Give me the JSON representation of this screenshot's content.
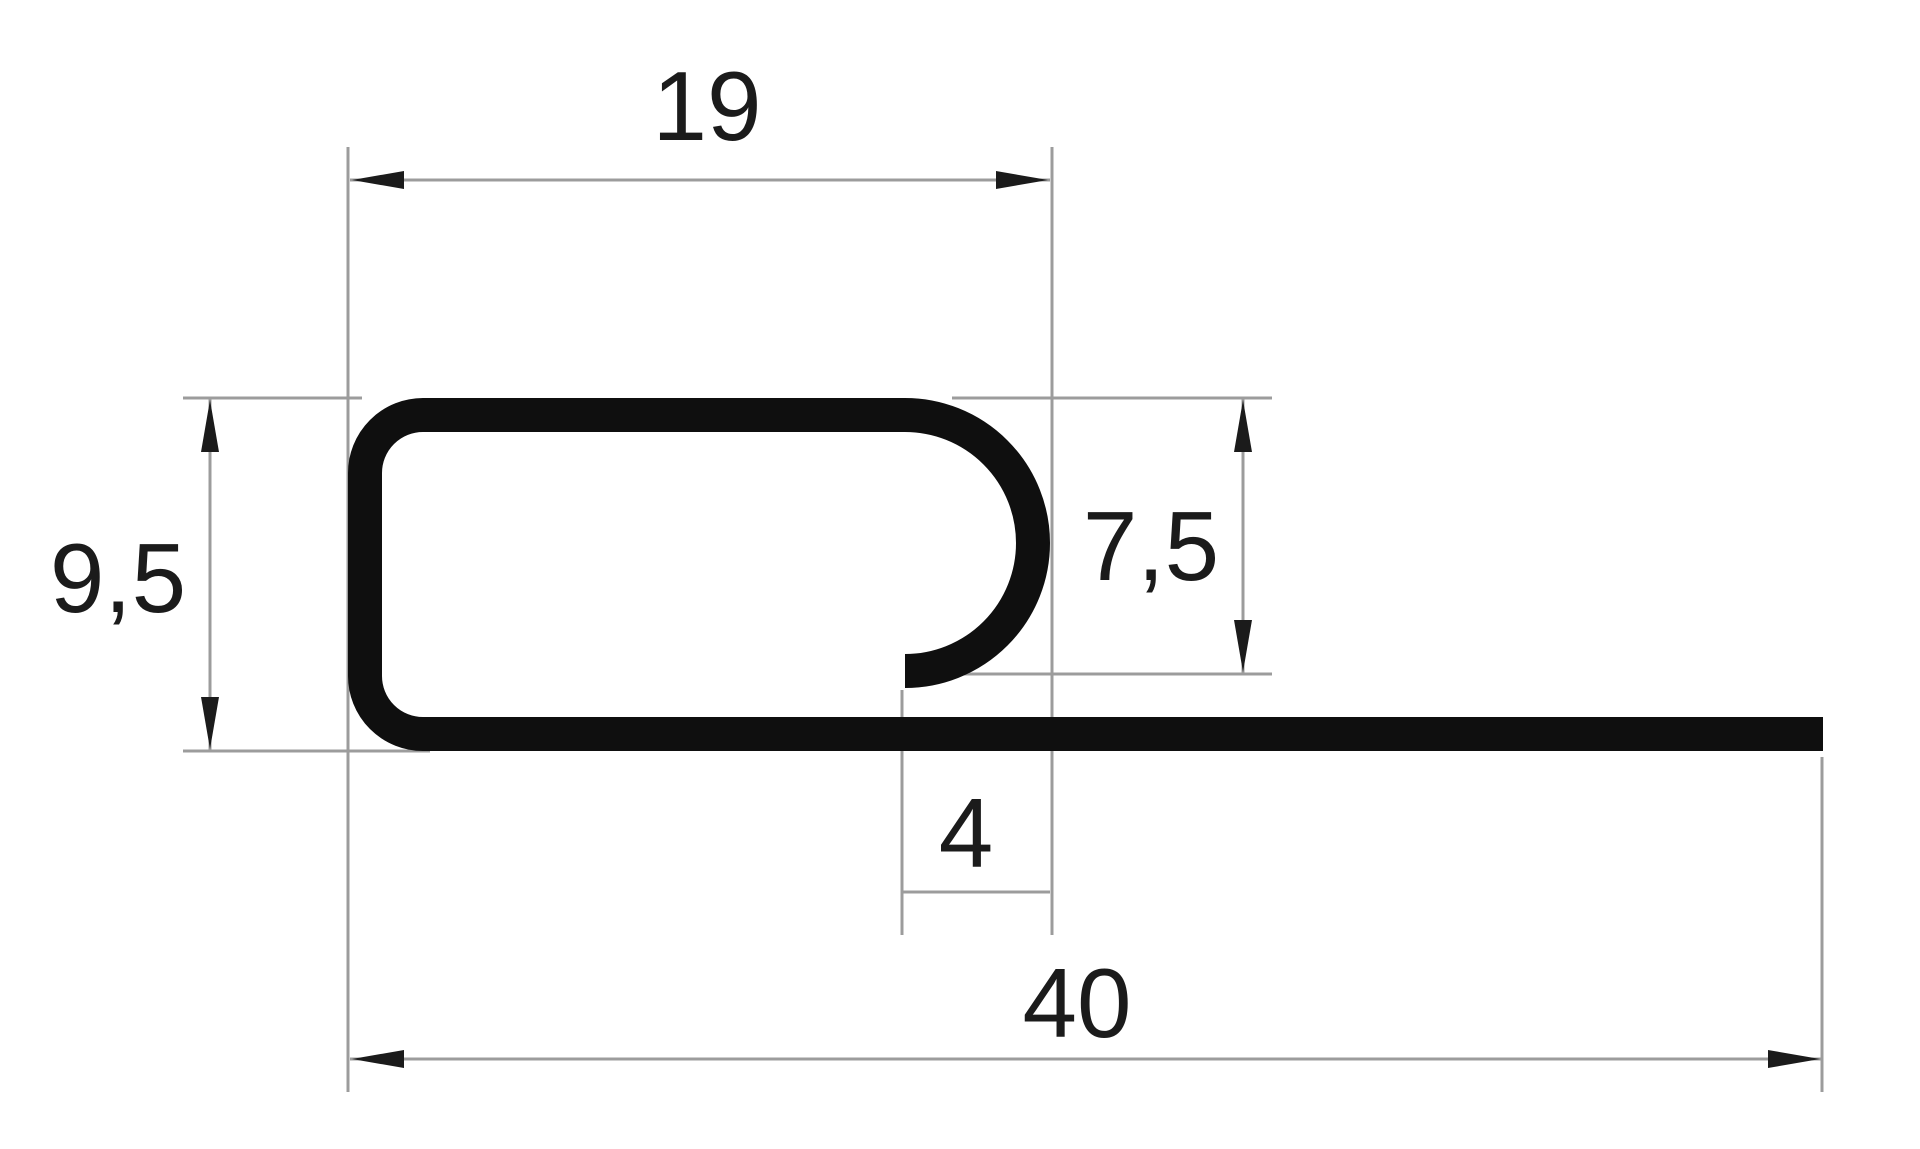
{
  "figure": {
    "title": "Dimensioned profile cross-section drawing",
    "type": "technical-drawing",
    "shape": "J-shaped channel profile with rounded corners, open hook on the right side and a long flat flange extending to the right"
  },
  "colors": {
    "bg-color": "#ffffff",
    "profile-color": "#0f0f0f",
    "dim-color": "#9c9c9c",
    "ink-color": "#1b1b1b"
  },
  "dimensions": {
    "top_width": {
      "label": "19",
      "value": 19,
      "orientation": "horizontal",
      "measures": "outer width of the channel box"
    },
    "left_height": {
      "label": "9,5",
      "value": 9.5,
      "orientation": "vertical",
      "measures": "outer height of the channel box"
    },
    "hook_height": {
      "label": "7,5",
      "value": 7.5,
      "orientation": "vertical",
      "measures": "depth from top face to hook tip"
    },
    "hook_opening": {
      "label": "4",
      "value": 4,
      "orientation": "horizontal",
      "measures": "hook tip to outer right face"
    },
    "total_width": {
      "label": "40",
      "value": 40,
      "orientation": "horizontal",
      "measures": "overall width including flange"
    }
  }
}
